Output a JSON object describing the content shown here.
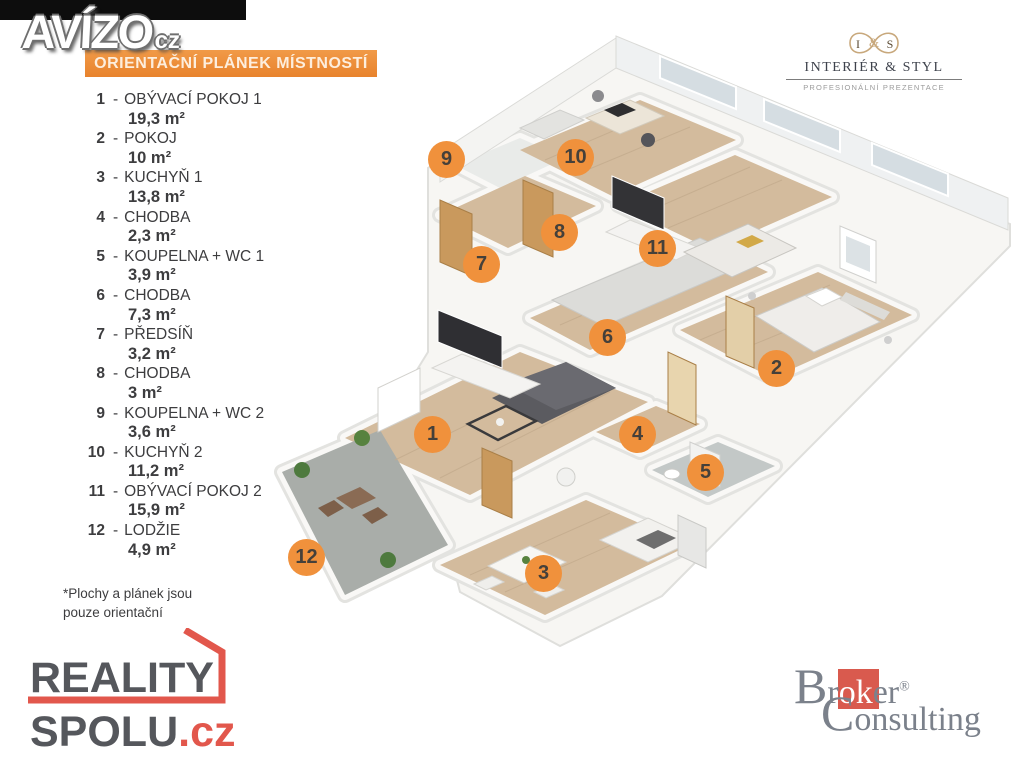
{
  "watermark": {
    "brand": "AVÍZO",
    "tld": "cz"
  },
  "header": {
    "title": "ORIENTAČNÍ PLÁNEK MÍSTNOSTÍ"
  },
  "legend": {
    "items": [
      {
        "num": "1",
        "name": "OBÝVACÍ POKOJ 1",
        "area": "19,3 m²"
      },
      {
        "num": "2",
        "name": "POKOJ",
        "area": "10 m²"
      },
      {
        "num": "3",
        "name": "KUCHYŇ 1",
        "area": "13,8 m²"
      },
      {
        "num": "4",
        "name": "CHODBA",
        "area": "2,3 m²"
      },
      {
        "num": "5",
        "name": "KOUPELNA + WC 1",
        "area": "3,9 m²"
      },
      {
        "num": "6",
        "name": "CHODBA",
        "area": "7,3 m²"
      },
      {
        "num": "7",
        "name": "PŘEDSÍŇ",
        "area": "3,2 m²"
      },
      {
        "num": "8",
        "name": "CHODBA",
        "area": "3 m²"
      },
      {
        "num": "9",
        "name": "KOUPELNA + WC 2",
        "area": "3,6 m²"
      },
      {
        "num": "10",
        "name": "KUCHYŇ 2",
        "area": "11,2 m²"
      },
      {
        "num": "11",
        "name": "OBÝVACÍ POKOJ 2",
        "area": "15,9 m²"
      },
      {
        "num": "12",
        "name": "LODŽIE",
        "area": "4,9 m²"
      }
    ],
    "footnote_line1": "*Plochy  a plánek jsou",
    "footnote_line2": "pouze orientační"
  },
  "plan": {
    "badges": [
      {
        "label": "1"
      },
      {
        "label": "2"
      },
      {
        "label": "3"
      },
      {
        "label": "4"
      },
      {
        "label": "5"
      },
      {
        "label": "6"
      },
      {
        "label": "7"
      },
      {
        "label": "8"
      },
      {
        "label": "9"
      },
      {
        "label": "10"
      },
      {
        "label": "11"
      },
      {
        "label": "12"
      }
    ]
  },
  "logos": {
    "interier_styl": {
      "monogram_left": "I",
      "monogram_amp": "&",
      "monogram_right": "S",
      "title": "INTERIÉR & STYL",
      "subtitle": "PROFESIONÁLNÍ PREZENTACE"
    },
    "reality_spolu": {
      "line1": "REALITY",
      "line2": "SPOLU",
      "tld": ".cz"
    },
    "broker": {
      "initial1": "B",
      "pre": "r",
      "mid": "ok",
      "post": "er",
      "reg": "®",
      "initial2": "C",
      "line2rest": "onsulting"
    }
  },
  "colors": {
    "accent_orange": "#f0913c",
    "banner_orange": "#e8832d",
    "reality_red": "#e2574c",
    "broker_red": "#d95a4e",
    "gold": "#c8a87c",
    "wood_floor": "#d3bb9d"
  }
}
